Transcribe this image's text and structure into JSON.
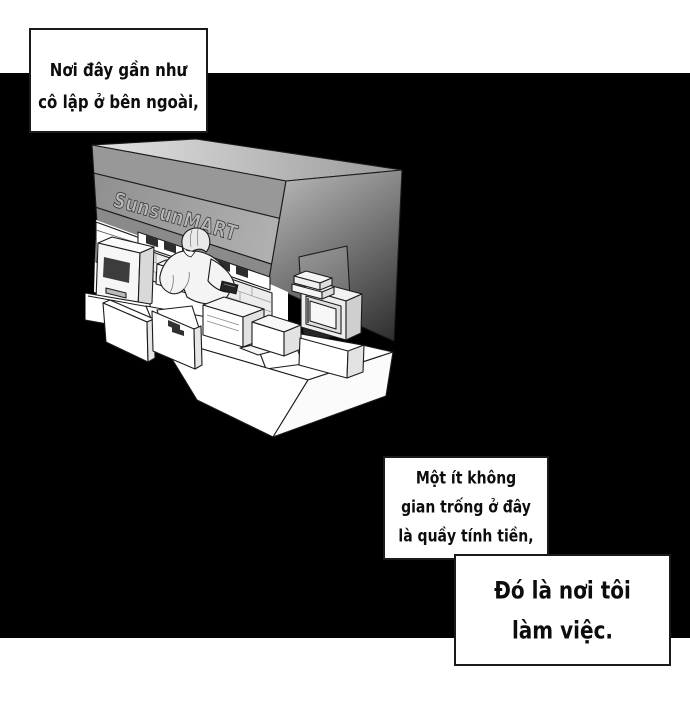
{
  "comic": {
    "narration_boxes": [
      {
        "id": "box1",
        "lines": [
          "Nơi đây gần như",
          "cô lập ở bên ngoài,"
        ]
      },
      {
        "id": "box2",
        "lines": [
          "Một ít không",
          "gian trống ở đây",
          "là quầy tính tiền,"
        ]
      },
      {
        "id": "box3",
        "lines": [
          "Đó là nơi tôi",
          "làm việc."
        ]
      }
    ],
    "store_sign": "SunsunMART"
  },
  "colors": {
    "page_background": "#ffffff",
    "panel_background": "#000000",
    "box_border": "#1a1a1a",
    "text": "#0d0d0d",
    "line_art": "#1b1b1b"
  }
}
